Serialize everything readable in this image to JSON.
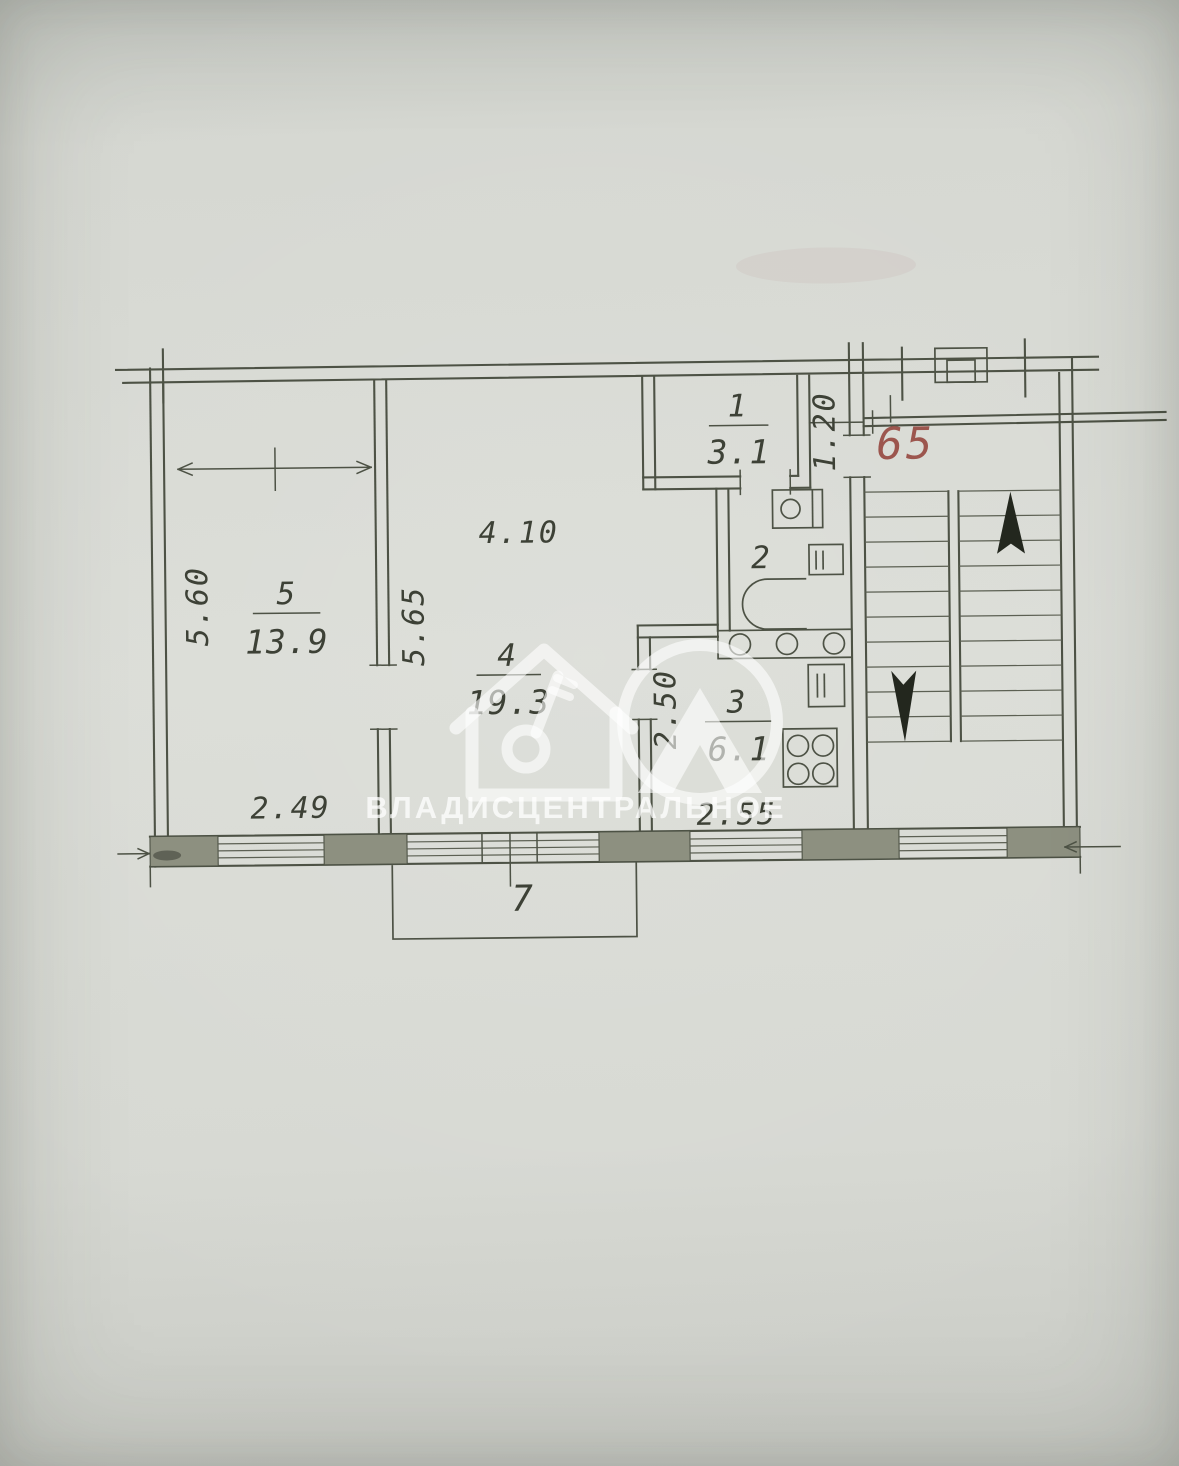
{
  "plan": {
    "apartment_number": "65",
    "watermark_text": "ВЛАДИСЦЕНТРАЛЬНОЕ",
    "rooms": {
      "r1": {
        "number": "1",
        "area": "3.1"
      },
      "r2": {
        "number": "2"
      },
      "r3": {
        "number": "3",
        "area": "6.1"
      },
      "r4": {
        "number": "4",
        "area": "19.3"
      },
      "r5": {
        "number": "5",
        "area": "13.9"
      },
      "r7": {
        "number": "7"
      }
    },
    "dimensions": {
      "room5_height": "5.60",
      "room5_width": "2.49",
      "room4_height": "5.65",
      "room4_width": "4.10",
      "hall_width": "1.20",
      "kitchen_height": "2.50",
      "kitchen_width": "2.55"
    },
    "colors": {
      "ink": "#4d5245",
      "wall_fill": "#8d9080",
      "apartment_number_red": "#9c564e",
      "paper": "#d7d9d3"
    }
  }
}
